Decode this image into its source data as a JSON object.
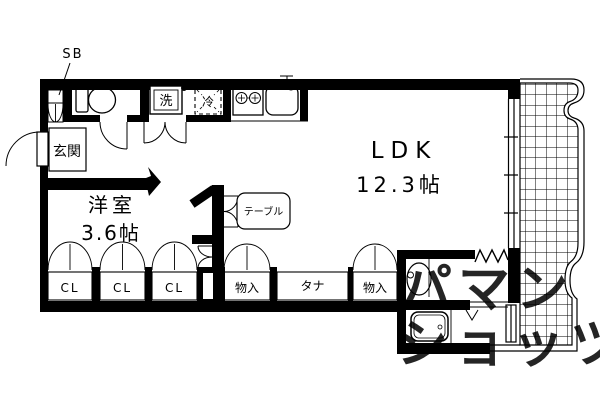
{
  "floorplan": {
    "rooms": {
      "ldk": {
        "name": "LDK",
        "size": "12.3帖"
      },
      "western_room": {
        "name": "洋室",
        "size": "3.6帖"
      },
      "entrance": {
        "label": "玄関"
      },
      "shoe_box": {
        "label": "SB"
      }
    },
    "kitchen": {
      "washer_label": "洗",
      "fridge_label": "冷"
    },
    "furniture": {
      "table_label": "テーブル"
    },
    "storage": {
      "closets": [
        {
          "label": "CL"
        },
        {
          "label": "CL"
        },
        {
          "label": "CL"
        }
      ],
      "storage_left": "物入",
      "shelf": "タナ",
      "storage_right": "物入"
    },
    "watermark": {
      "line1": "パマン",
      "line2": "ショッツ",
      "color": "#c8c8c8"
    },
    "icons": [
      "toilet-icon",
      "washbasin-icon",
      "bathtub-icon",
      "stove-icon",
      "sink-icon",
      "door-arc-icon",
      "balcony-grid-icon",
      "entry-arrow-icon",
      "accordion-door-icon"
    ],
    "colors": {
      "wall": "#000000",
      "floor": "#ffffff",
      "line": "#000000"
    }
  }
}
